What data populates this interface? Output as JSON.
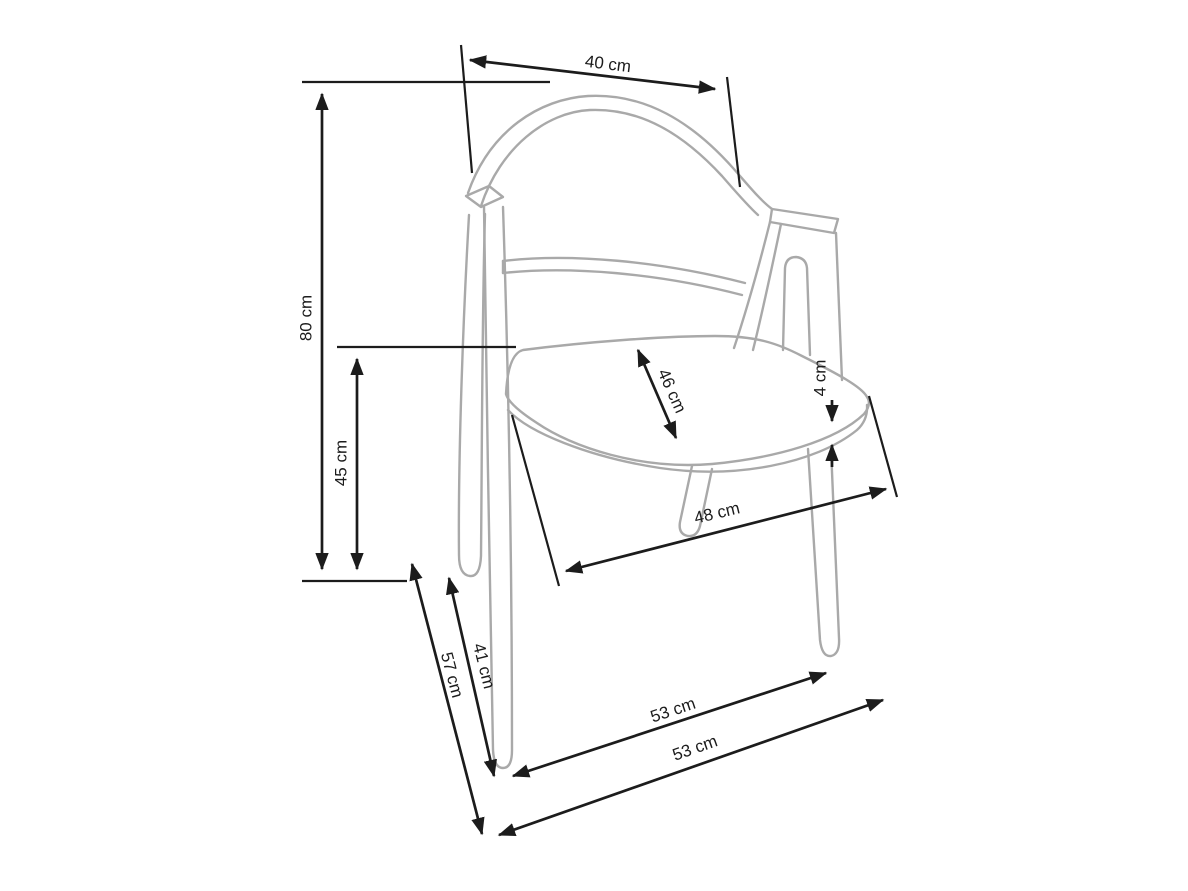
{
  "diagram": {
    "type": "furniture-dimension-drawing",
    "subject": "armchair line drawing with dimension arrows",
    "background_color": "#ffffff",
    "dimension_line_color": "#1c1c1c",
    "chair_line_color": "#a9a9a9",
    "unit": "cm",
    "dimensions": {
      "top_width": "40 cm",
      "total_height": "80 cm",
      "seat_height": "45 cm",
      "seat_depth": "46 cm",
      "seat_thickness": "4 cm",
      "seat_width": "48 cm",
      "inner_leg_depth": "41 cm",
      "outer_leg_depth": "57 cm",
      "base_width_upper": "53 cm",
      "base_width_lower": "53 cm"
    }
  }
}
